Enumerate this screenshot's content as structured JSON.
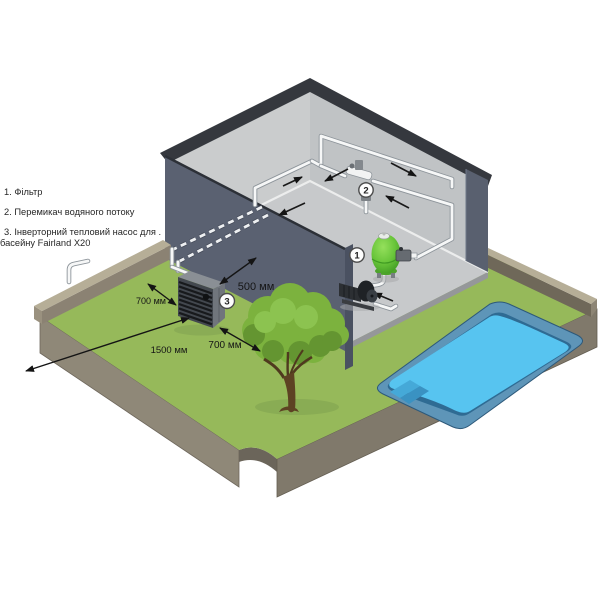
{
  "scene": {
    "background": "#ffffff"
  },
  "legend": {
    "items": [
      {
        "marker": "1",
        "label": "1. Фільтр"
      },
      {
        "marker": "2",
        "label": "2. Перемикач водяного потоку"
      },
      {
        "marker": "3",
        "label": "3. Інверторний тепловий насос для .",
        "label_line2": "басейну Fairland X20"
      }
    ]
  },
  "markers": {
    "filter": "1",
    "flow_switch": "2",
    "heat_pump": "3"
  },
  "dimensions": {
    "heat_pump_left": "700 мм",
    "heat_pump_rear": "500 мм",
    "heat_pump_front": "1500 мм",
    "heat_pump_right": "700 мм"
  },
  "colors": {
    "grass": "#96b95a",
    "grass_shadow": "#82a452",
    "pool_water": "#57c4f0",
    "pool_coping": "#5e95b8",
    "pool_wall": "#2f6b93",
    "yard_wall_top": "#b6ae97",
    "yard_wall_inner": "#8b8273",
    "yard_side_left": "#8f8878",
    "yard_side_right": "#80796b",
    "building_exterior": "#5a6171",
    "building_wall_left": "#cacccd",
    "building_wall_right": "#c0c3c5",
    "building_floor": "#c7c9cb",
    "roof_rim": "#35383e",
    "heat_pump_front": "#43484f",
    "heat_pump_side": "#70757c",
    "heat_pump_top": "#8a8f95",
    "filter_tank": "#69c53a",
    "pipe_white": "#f6f7f7",
    "tree_canopy": "#7cb23e",
    "tree_trunk": "#5d4223",
    "arrow_black": "#141414"
  }
}
